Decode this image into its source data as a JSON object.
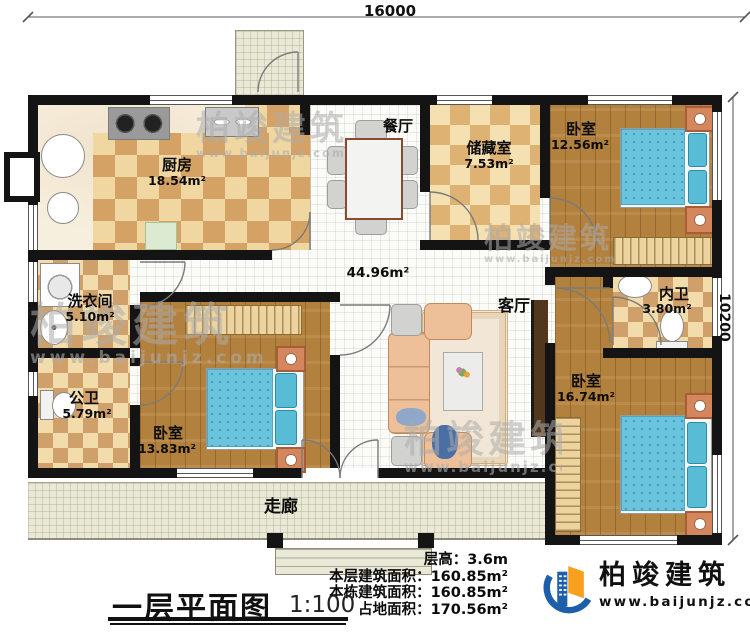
{
  "dimensions": {
    "top": "16000",
    "right": "10200"
  },
  "rooms": {
    "kitchen": {
      "name": "厨房",
      "area": "18.54m²"
    },
    "dining": {
      "name": "餐厅"
    },
    "storage": {
      "name": "储藏室",
      "area": "7.53m²"
    },
    "bedroom_top_right": {
      "name": "卧室",
      "area": "12.56m²"
    },
    "laundry": {
      "name": "洗衣间",
      "area": "5.10m²"
    },
    "public_bath": {
      "name": "公卫",
      "area": "5.79m²"
    },
    "bedroom_bottom_left": {
      "name": "卧室",
      "area": "13.83m²"
    },
    "living": {
      "name": "客厅",
      "area": "44.96m²"
    },
    "inner_bath": {
      "name": "内卫",
      "area": "3.80m²"
    },
    "bedroom_bottom_right": {
      "name": "卧室",
      "area": "16.74m²"
    },
    "corridor": {
      "name": "走廊"
    }
  },
  "info": {
    "lines": [
      {
        "label": "层高：",
        "value": "3.6m"
      },
      {
        "label": "本层建筑面积：",
        "value": "160.85m²"
      },
      {
        "label": "本栋建筑面积：",
        "value": "160.85m²"
      },
      {
        "label": "占地面积：",
        "value": "170.56m²"
      }
    ]
  },
  "title": {
    "text": "一层平面图",
    "scale": "1:100"
  },
  "brand": {
    "name": "柏竣建筑",
    "url": "www.baijunjz.com"
  },
  "colors": {
    "wall": "#141414",
    "wood_floor": "#b3813e",
    "checker_dark": "#d4a264",
    "checker_light": "#f0d7a2",
    "bed_blue": "#6ac4de",
    "corridor_tile": "#eae8d6",
    "brand_blue": "#1d5fa8",
    "brand_orange": "#f6a01d"
  }
}
